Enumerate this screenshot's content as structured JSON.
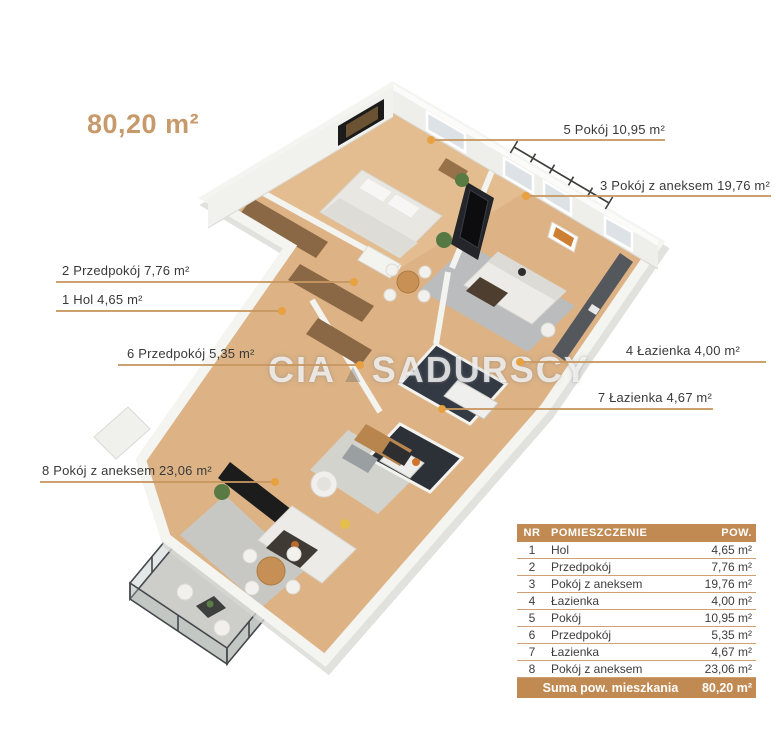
{
  "title": {
    "text": "80,20 m²"
  },
  "watermark": {
    "part1": "CIA",
    "part2": "SADURSCY"
  },
  "labels": [
    {
      "nr": "5",
      "text": "5 Pokój 10,95 m²"
    },
    {
      "nr": "3",
      "text": "3 Pokój z aneksem 19,76 m²"
    },
    {
      "nr": "2",
      "text": "2 Przedpokój 7,76 m²"
    },
    {
      "nr": "1",
      "text": "1 Hol 4,65 m²"
    },
    {
      "nr": "6",
      "text": "6 Przedpokój 5,35 m²"
    },
    {
      "nr": "4",
      "text": "4 Łazienka 4,00 m²"
    },
    {
      "nr": "7",
      "text": "7 Łazienka 4,67 m²"
    },
    {
      "nr": "8",
      "text": "8 Pokój z aneksem 23,06 m²"
    }
  ],
  "table": {
    "headers": {
      "nr": "NR",
      "room": "POMIESZCZENIE",
      "area": "POW."
    },
    "rows": [
      {
        "nr": "1",
        "room": "Hol",
        "area": "4,65 m²"
      },
      {
        "nr": "2",
        "room": "Przedpokój",
        "area": "7,76 m²"
      },
      {
        "nr": "3",
        "room": "Pokój z aneksem",
        "area": "19,76 m²"
      },
      {
        "nr": "4",
        "room": "Łazienka",
        "area": "4,00 m²"
      },
      {
        "nr": "5",
        "room": "Pokój",
        "area": "10,95 m²"
      },
      {
        "nr": "6",
        "room": "Przedpokój",
        "area": "5,35 m²"
      },
      {
        "nr": "7",
        "room": "Łazienka",
        "area": "4,67 m²"
      },
      {
        "nr": "8",
        "room": "Pokój z aneksem",
        "area": "23,06 m²"
      }
    ],
    "footer": {
      "label": "Suma pow. mieszkania",
      "value": "80,20 m²"
    }
  },
  "colors": {
    "accent_tan": "#c08a52",
    "leader_line": "#c6975f",
    "dot_orange": "#e7a140",
    "title_tan": "#c79a6b",
    "text_dark": "#3a3a3a",
    "wood_floor": "#ddb385",
    "dark_bath": "#343a44"
  }
}
